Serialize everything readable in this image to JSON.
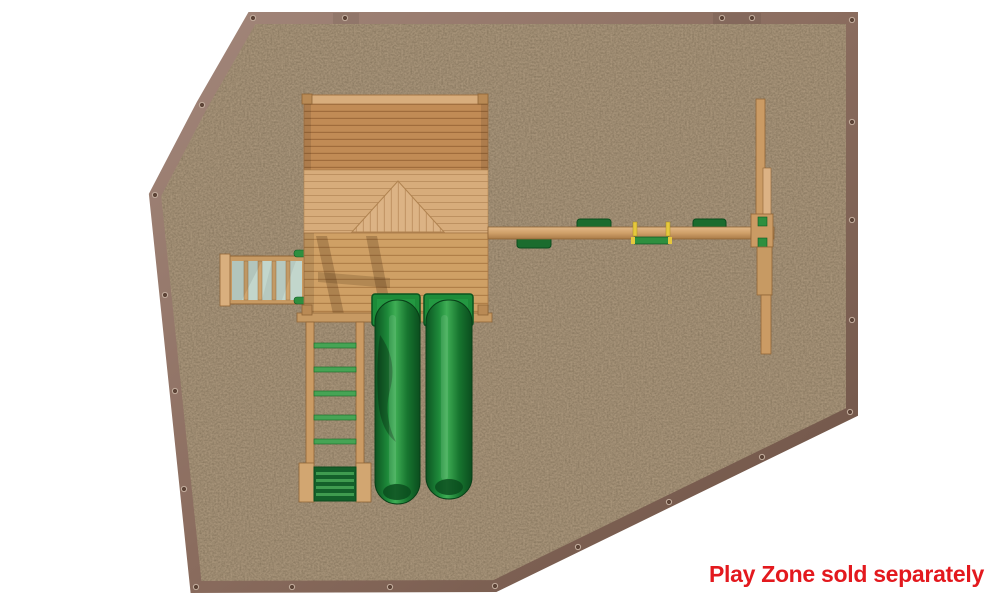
{
  "caption": {
    "text": "Play Zone sold separately"
  },
  "colors": {
    "background": "#ffffff",
    "caption_red": "#e3191e",
    "mulch_brown": "#58432d",
    "border_taupe": "#8a6c5e",
    "wood_light": "#d9af7e",
    "wood_mid": "#cfa069",
    "wood_dark": "#a97440",
    "roof_wood": "#c18b55",
    "slide_green": "#1e8a3a",
    "slide_green_dark": "#0b4d1e",
    "seat_green": "#1b6c2e",
    "rung_green": "#46a455",
    "ramp_panel_green": "#c2d6cc",
    "handle_yellow": "#e6c83d"
  },
  "components": {
    "play_zone": "play-zone-mulch-surface",
    "border": "timber-border",
    "fort": "fort-deck-with-roof",
    "ramp": "climbing-ramp",
    "monkey_bars": "monkey-bars",
    "slides": [
      "green-slide-left",
      "green-slide-right"
    ],
    "swings": [
      "swing-seat-1",
      "swing-seat-2",
      "glider-swing",
      "swing-seat-3"
    ],
    "swing_frame": [
      "swing-beam",
      "swing-aframe-end"
    ]
  }
}
